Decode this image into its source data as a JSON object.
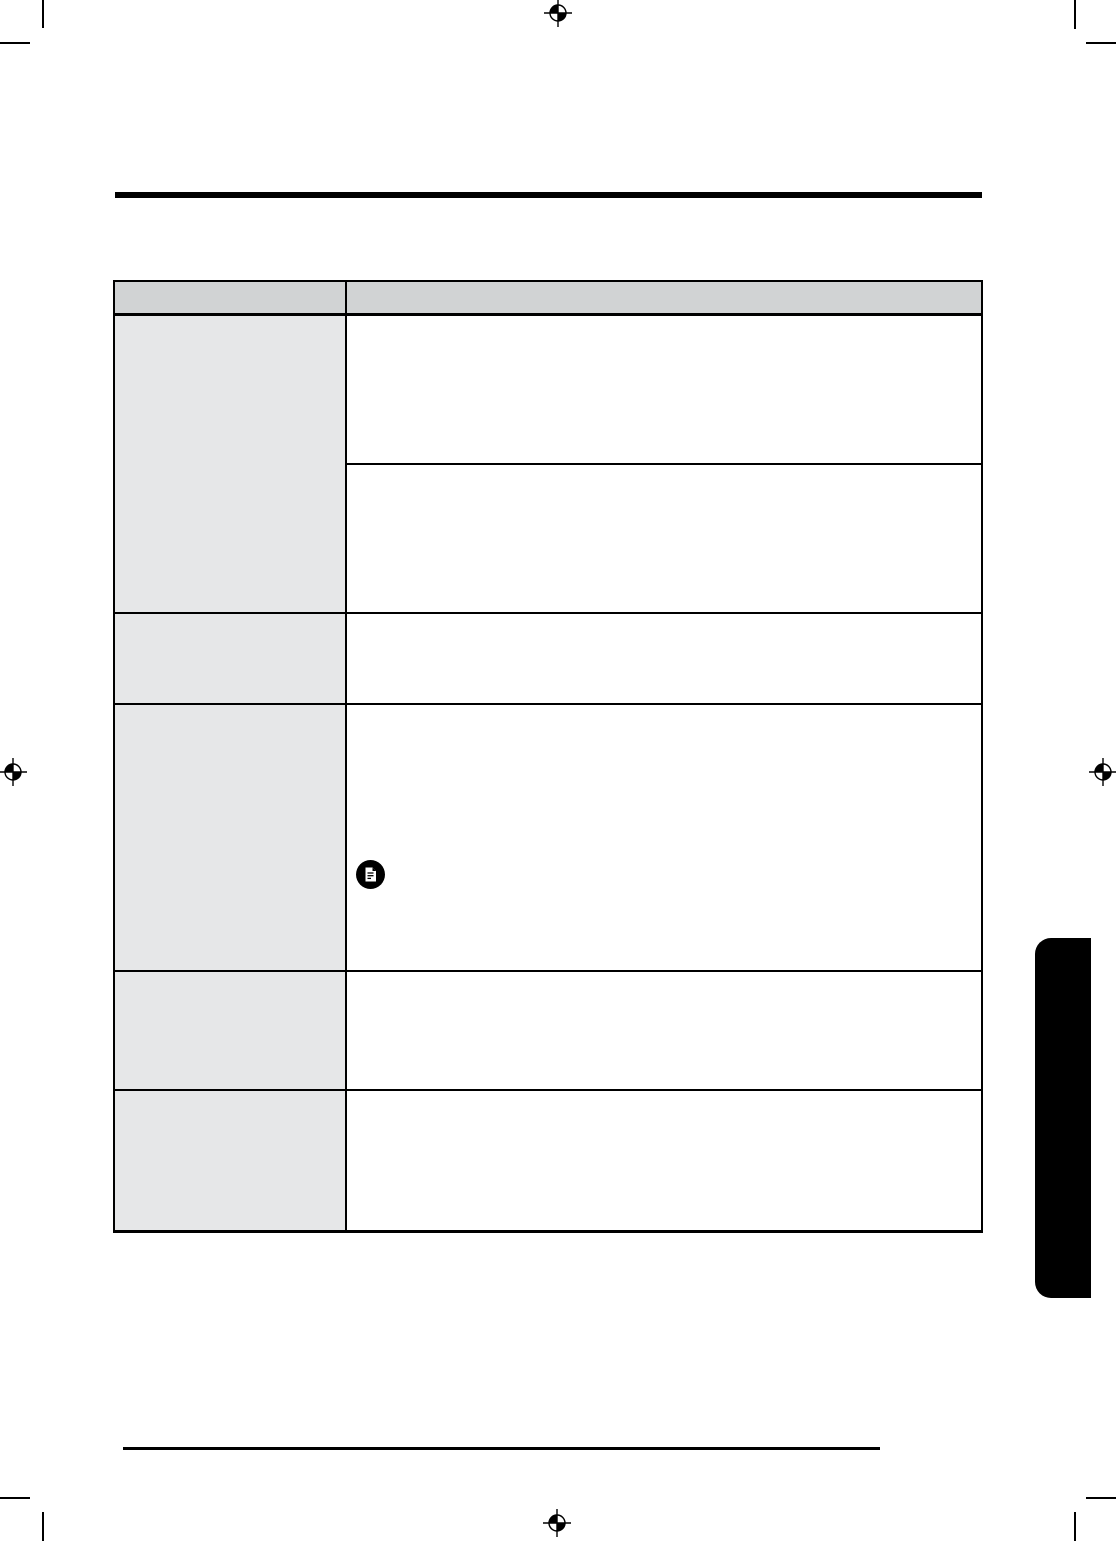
{
  "page": {
    "background_color": "#ffffff",
    "ink_color": "#000000"
  },
  "print_marks": {
    "crop_mark_icon": "crop-mark-icon",
    "registration_icon": "registration-target-icon",
    "registration_positions": [
      "top-center",
      "left-middle",
      "right-middle",
      "bottom-center"
    ],
    "crop_positions": [
      "top-left",
      "top-right",
      "bottom-left",
      "bottom-right"
    ]
  },
  "header": {
    "title_text": "",
    "rule_color": "#000000"
  },
  "troubleshooting_table": {
    "header_fill_color": "#d1d3d4",
    "label_fill_color": "#e6e7e8",
    "border_color": "#000000",
    "columns": [
      {
        "header_text": ""
      },
      {
        "header_text": ""
      }
    ],
    "rows": [
      {
        "label_text": "",
        "detail_cells": [
          "",
          ""
        ]
      },
      {
        "label_text": "",
        "detail_cells": [
          ""
        ]
      },
      {
        "label_text": "",
        "detail_cells": [
          ""
        ],
        "note_icon": "note-document-icon"
      },
      {
        "label_text": "",
        "detail_cells": [
          ""
        ]
      },
      {
        "label_text": "",
        "detail_cells": [
          ""
        ]
      }
    ]
  },
  "side_tab": {
    "label_text": "",
    "fill_color": "#000000"
  },
  "footer": {
    "text": "",
    "rule_color": "#000000"
  }
}
